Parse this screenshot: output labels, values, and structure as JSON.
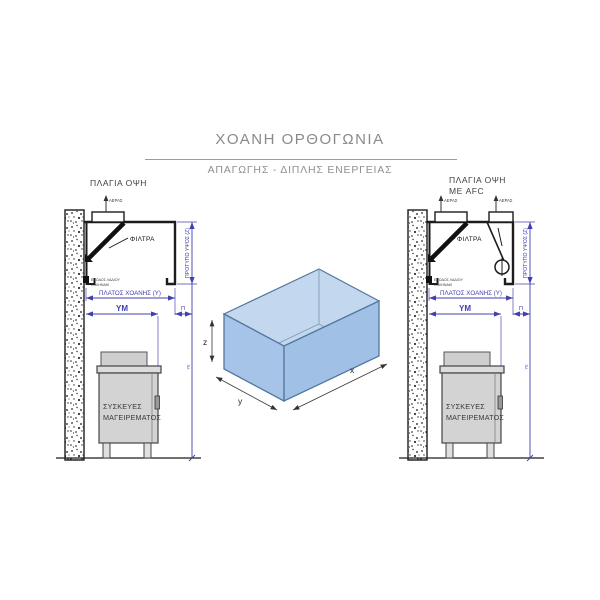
{
  "header": {
    "title": "ΧΟΑΝΗ ΟΡΘΟΓΩΝΙΑ",
    "subtitle": "ΑΠΑΓΩΓΗΣ - ΔΙΠΛΗΣ ΕΝΕΡΓΕΙΑΣ"
  },
  "views": {
    "left": {
      "caption": "ΠΛΑΓΙΑ ΟΨΗ"
    },
    "right": {
      "caption_line1": "ΠΛΑΓΙΑ ΟΨΗ",
      "caption_line2": "ΜΕ AFC"
    }
  },
  "labels": {
    "filters": "ΦΙΛΤΡΑ",
    "air": "ΑΕΡΑΣ",
    "oil_outlet_line1": "ΕΞΟΔΟΣ ΛΑΔΙΟΥ",
    "oil_outlet_line2": "ΣΩΛΗΝΑΚΙ",
    "hood_width": "ΠΛΑΤΟΣ ΧΟΑΝΗΣ (Υ)",
    "mounting_height": "ΥΜ",
    "overhang": "Π",
    "standard_height": "ΠΡΟΤΥΠΟ ΥΨΟΣ (Ζ)",
    "floor_height": "ΥΕ",
    "appliances_line1": "ΣΥΣΚΕΥΕΣ",
    "appliances_line2": "ΜΑΓΕΙΡΕΜΑΤΟΣ"
  },
  "box3d": {
    "axis_x": "x",
    "axis_y": "y",
    "axis_z": "z"
  },
  "colors": {
    "dimension_blue": "#4040ae",
    "title_gray": "#8a8a8a",
    "drawing_line": "#1c1c1c",
    "box_face": "#a6c4e7",
    "box_face_right": "#a0c0e5",
    "box_opening": "#c3d7ee",
    "box_edge": "#54779d",
    "appliance_fill": "#d3d3d3"
  }
}
